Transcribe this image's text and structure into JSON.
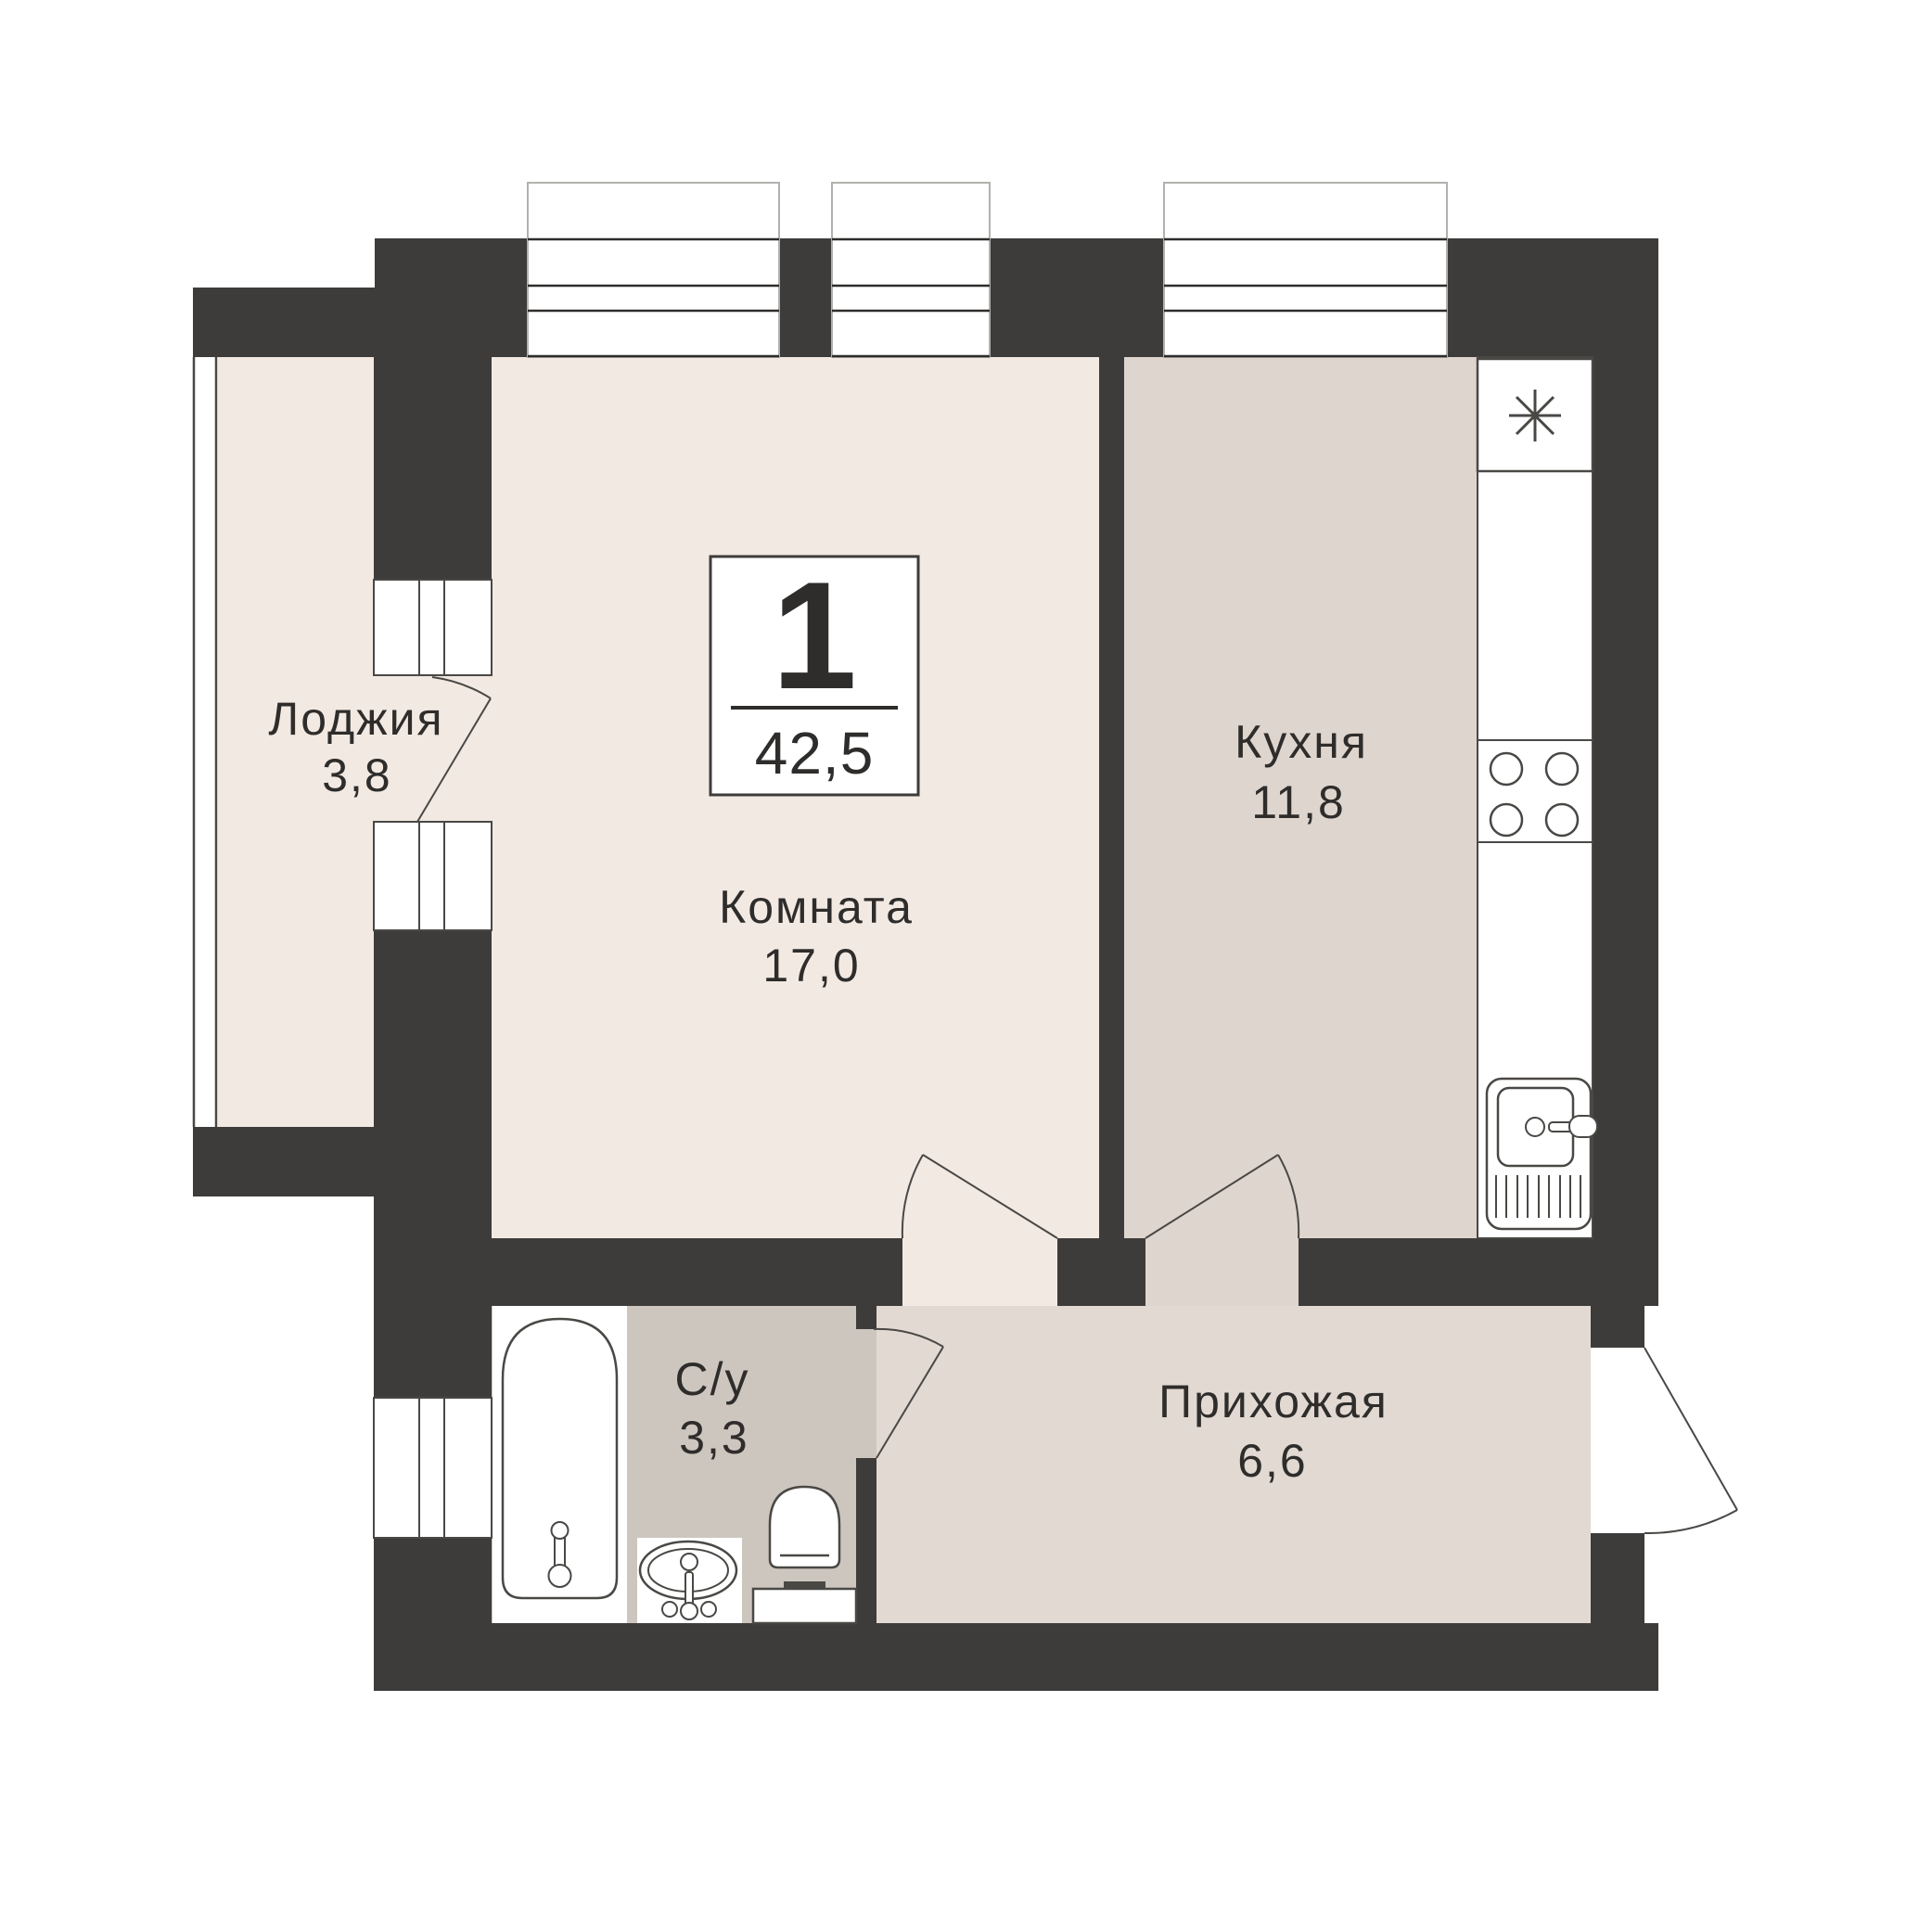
{
  "badge": {
    "rooms_count": "1",
    "total_area": "42,5"
  },
  "rooms": [
    {
      "key": "loggia",
      "label": "Лоджия",
      "area": "3,8"
    },
    {
      "key": "living-room",
      "label": "Комната",
      "area": "17,0"
    },
    {
      "key": "kitchen",
      "label": "Кухня",
      "area": "11,8"
    },
    {
      "key": "bathroom",
      "label": "С/у",
      "area": "3,3"
    },
    {
      "key": "hallway",
      "label": "Прихожая",
      "area": "6,6"
    }
  ],
  "icons": {
    "fridge_icon": "asterisk",
    "stove_icon": "four-burner-stove",
    "kitchen_sink_icon": "sink-with-drainboard",
    "bathtub_icon": "bathtub",
    "washbasin_icon": "oval-basin",
    "toilet_icon": "toilet"
  },
  "colors": {
    "wall": "#3e3c3a",
    "room": "#f2e9e3",
    "kitchen": "#ded5ce",
    "hallway": "#e1d9d2",
    "bathroom": "#cdc6bf",
    "outline": "#4a4845",
    "text": "#2f2d2b",
    "window_frame": "#b3b1ae"
  }
}
